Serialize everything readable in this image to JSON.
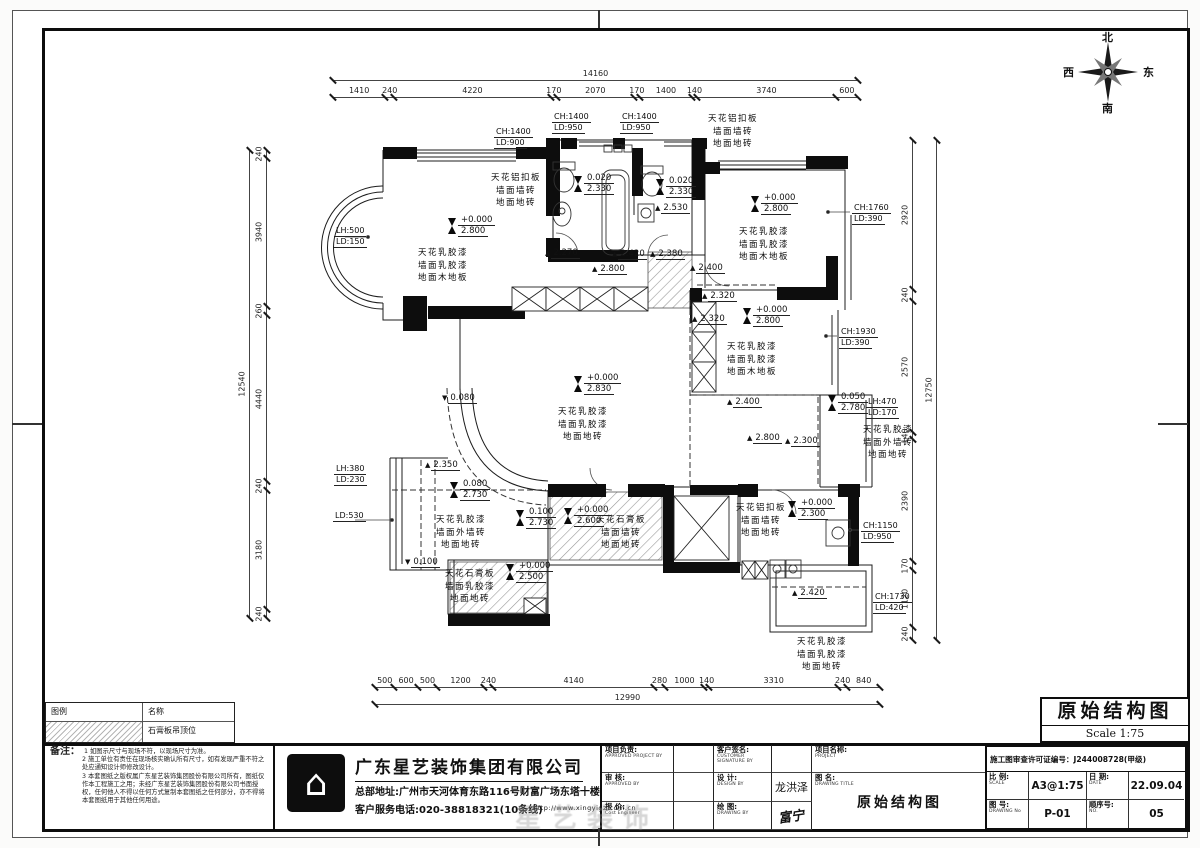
{
  "titlebox": {
    "title": "原始结构图",
    "scale": "Scale 1:75"
  },
  "compass": {
    "n": "北",
    "s": "南",
    "e": "东",
    "w": "西"
  },
  "legend": {
    "h1": "图例",
    "h2": "名称",
    "item1": "石膏板吊顶位"
  },
  "notes": {
    "label": "备注：",
    "items": [
      "1 如图示尺寸与现场不符，以现场尺寸为准。",
      "2 施工单位有责任在现场核实确认所有尺寸，如有发现严重不符之处应通知设计师修改设计。",
      "3 本套图纸之版权属广东星艺装饰集团股份有限公司所有，图纸仅作本工程施工之用；未经广东星艺装饰集团股份有限公司书面授权，任何他人不得以任何方式复制本套图纸之任何部分，亦不得将本套图纸用于其他任何用途。"
    ]
  },
  "company": {
    "name": "广东星艺装饰集团有限公司",
    "address": "总部地址:广州市天河体育东路116号财富广场东塔十楼",
    "phone": "客户服务电话:020-38818321(10条线)",
    "url": "http://www.xingyigz.com.cn",
    "logo_glyph": "⌂"
  },
  "block": {
    "proj_lead_cn": "项目负责:",
    "proj_lead_en": "APPROVED PROJECT BY",
    "customer_cn": "客户签名:",
    "customer_en": "CUSTOMER SIGNATURE BY",
    "check_cn": "审 核:",
    "check_en": "APPROVED BY",
    "design_cn": "设 计:",
    "design_en": "DESIGN BY",
    "design_val": "龙洪泽",
    "quote_cn": "报 价:",
    "quote_en": "Cost Engineer",
    "draw_cn": "绘 图:",
    "draw_en": "DRAWING BY",
    "draw_val": "富宁",
    "project_cn": "项目名称:",
    "project_en": "PROJECT",
    "figname_cn": "图 名:",
    "figname_en": "DRAWING TITLE",
    "license": "施工图审查许可证编号：J244008728(甲级)",
    "scale_cn": "比 例:",
    "scale_en": "SCALE",
    "scale_val": "A3@1:75",
    "date_cn": "日 期:",
    "date_en": "DATE",
    "date_val": "22.09.04",
    "no_cn": "图 号:",
    "no_en": "DRAWING No",
    "no_val": "P-01",
    "seq_cn": "顺序号:",
    "seq_en": "NO.",
    "seq_val": "05"
  },
  "watermark": "星艺装饰",
  "dimensions": [
    {
      "dir": "h",
      "x": 333,
      "y": 80,
      "len": 525,
      "values": [
        "14160"
      ]
    },
    {
      "dir": "h",
      "x": 333,
      "y": 97,
      "len": 525,
      "values": [
        "1410",
        "240",
        "4220",
        "170",
        "2070",
        "170",
        "1400",
        "140",
        "3740",
        "600"
      ]
    },
    {
      "dir": "h",
      "x": 375,
      "y": 687,
      "len": 505,
      "values": [
        "500",
        "600",
        "500",
        "1200",
        "240",
        "4140",
        "280",
        "1000",
        "140",
        "3310",
        "240",
        "840"
      ]
    },
    {
      "dir": "h",
      "x": 375,
      "y": 704,
      "len": 505,
      "values": [
        "12990"
      ]
    },
    {
      "dir": "v",
      "x": 266,
      "y": 150,
      "len": 468,
      "values": [
        "240",
        "3940",
        "260",
        "4440",
        "240",
        "3180",
        "240"
      ]
    },
    {
      "dir": "v",
      "x": 249,
      "y": 150,
      "len": 468,
      "values": [
        "12540"
      ]
    },
    {
      "dir": "v",
      "x": 912,
      "y": 140,
      "len": 500,
      "values": [
        "2920",
        "240",
        "2570",
        "140",
        "2390",
        "170",
        "1120",
        "240"
      ]
    },
    {
      "dir": "v",
      "x": 936,
      "y": 140,
      "len": 500,
      "values": [
        "12750"
      ]
    }
  ],
  "plan": {
    "finish_labels": [
      {
        "x": 443,
        "y": 247,
        "lines": [
          "天花乳胶漆",
          "墙面乳胶漆",
          "地面木地板"
        ]
      },
      {
        "x": 516,
        "y": 172,
        "lines": [
          "天花铝扣板",
          "墙面墙砖",
          "地面地砖"
        ]
      },
      {
        "x": 733,
        "y": 113,
        "lines": [
          "天花铝扣板",
          "墙面墙砖",
          "地面地砖"
        ]
      },
      {
        "x": 764,
        "y": 226,
        "lines": [
          "天花乳胶漆",
          "墙面乳胶漆",
          "地面木地板"
        ]
      },
      {
        "x": 752,
        "y": 341,
        "lines": [
          "天花乳胶漆",
          "墙面乳胶漆",
          "地面木地板"
        ]
      },
      {
        "x": 583,
        "y": 406,
        "lines": [
          "天花乳胶漆",
          "墙面乳胶漆",
          "地面地砖"
        ]
      },
      {
        "x": 461,
        "y": 514,
        "lines": [
          "天花乳胶漆",
          "墙面外墙砖",
          "地面地砖"
        ]
      },
      {
        "x": 888,
        "y": 424,
        "lines": [
          "天花乳胶漆",
          "墙面外墙砖",
          "地面地砖"
        ]
      },
      {
        "x": 621,
        "y": 514,
        "lines": [
          "天花石膏板",
          "墙面墙砖",
          "地面地砖"
        ]
      },
      {
        "x": 470,
        "y": 568,
        "lines": [
          "天花石膏板",
          "墙面乳胶漆",
          "地面地砖"
        ]
      },
      {
        "x": 761,
        "y": 502,
        "lines": [
          "天花铝扣板",
          "墙面墙砖",
          "地面地砖"
        ]
      },
      {
        "x": 822,
        "y": 636,
        "lines": [
          "天花乳胶漆",
          "墙面乳胶漆",
          "地面地砖"
        ]
      }
    ],
    "elev_double": [
      {
        "x": 448,
        "y": 224,
        "top": "+0.000",
        "bot": "2.800"
      },
      {
        "x": 751,
        "y": 202,
        "top": "+0.000",
        "bot": "2.800"
      },
      {
        "x": 743,
        "y": 314,
        "top": "+0.000",
        "bot": "2.800"
      },
      {
        "x": 574,
        "y": 382,
        "top": "+0.000",
        "bot": "2.830"
      },
      {
        "x": 564,
        "y": 514,
        "top": "+0.000",
        "bot": "2.600"
      },
      {
        "x": 506,
        "y": 570,
        "top": "+0.000",
        "bot": "2.500"
      },
      {
        "x": 788,
        "y": 507,
        "top": "+0.000",
        "bot": "2.300"
      },
      {
        "x": 574,
        "y": 182,
        "top": "0.020",
        "bot": "2.330"
      },
      {
        "x": 656,
        "y": 185,
        "top": "0.020",
        "bot": "2.330"
      },
      {
        "x": 828,
        "y": 401,
        "top": "0.050",
        "bot": "2.780"
      },
      {
        "x": 450,
        "y": 488,
        "top": "0.080",
        "bot": "2.730"
      },
      {
        "x": 516,
        "y": 516,
        "top": "0.100",
        "bot": "2.730"
      }
    ],
    "elev_single": [
      {
        "x": 545,
        "y": 248,
        "val": "2.270",
        "d": "up"
      },
      {
        "x": 592,
        "y": 264,
        "val": "2.800",
        "d": "up"
      },
      {
        "x": 612,
        "y": 249,
        "val": "2.420",
        "d": "up"
      },
      {
        "x": 650,
        "y": 249,
        "val": "2.380",
        "d": "up"
      },
      {
        "x": 690,
        "y": 263,
        "val": "2.400",
        "d": "up"
      },
      {
        "x": 702,
        "y": 291,
        "val": "2.320",
        "d": "up"
      },
      {
        "x": 692,
        "y": 314,
        "val": "2.320",
        "d": "up"
      },
      {
        "x": 655,
        "y": 203,
        "val": "2.530",
        "d": "up"
      },
      {
        "x": 425,
        "y": 460,
        "val": "2.350",
        "d": "up"
      },
      {
        "x": 442,
        "y": 393,
        "val": "0.080",
        "d": "dn"
      },
      {
        "x": 405,
        "y": 557,
        "val": "0.100",
        "d": "dn"
      },
      {
        "x": 727,
        "y": 397,
        "val": "2.400",
        "d": "up"
      },
      {
        "x": 747,
        "y": 433,
        "val": "2.800",
        "d": "up"
      },
      {
        "x": 785,
        "y": 436,
        "val": "2.300",
        "d": "up"
      },
      {
        "x": 792,
        "y": 588,
        "val": "2.420",
        "d": "up"
      }
    ],
    "ch_ld": [
      {
        "x": 494,
        "y": 127,
        "lines": [
          "CH:1400",
          "LD:900"
        ]
      },
      {
        "x": 552,
        "y": 112,
        "lines": [
          "CH:1400",
          "LD:950"
        ]
      },
      {
        "x": 620,
        "y": 112,
        "lines": [
          "CH:1400",
          "LD:950"
        ]
      },
      {
        "x": 852,
        "y": 203,
        "lines": [
          "CH:1760",
          "LD:390"
        ]
      },
      {
        "x": 839,
        "y": 327,
        "lines": [
          "CH:1930",
          "LD:390"
        ]
      },
      {
        "x": 861,
        "y": 521,
        "lines": [
          "CH:1150",
          "LD:950"
        ]
      },
      {
        "x": 873,
        "y": 592,
        "lines": [
          "CH:1730",
          "LD:420"
        ]
      },
      {
        "x": 334,
        "y": 226,
        "lines": [
          "LH:500",
          "LD:150"
        ]
      },
      {
        "x": 866,
        "y": 397,
        "lines": [
          "LH:470",
          "LD:170"
        ]
      },
      {
        "x": 334,
        "y": 464,
        "lines": [
          "LH:380",
          "LD:230"
        ]
      },
      {
        "x": 333,
        "y": 511,
        "lines": [
          "LD:530"
        ]
      }
    ]
  }
}
